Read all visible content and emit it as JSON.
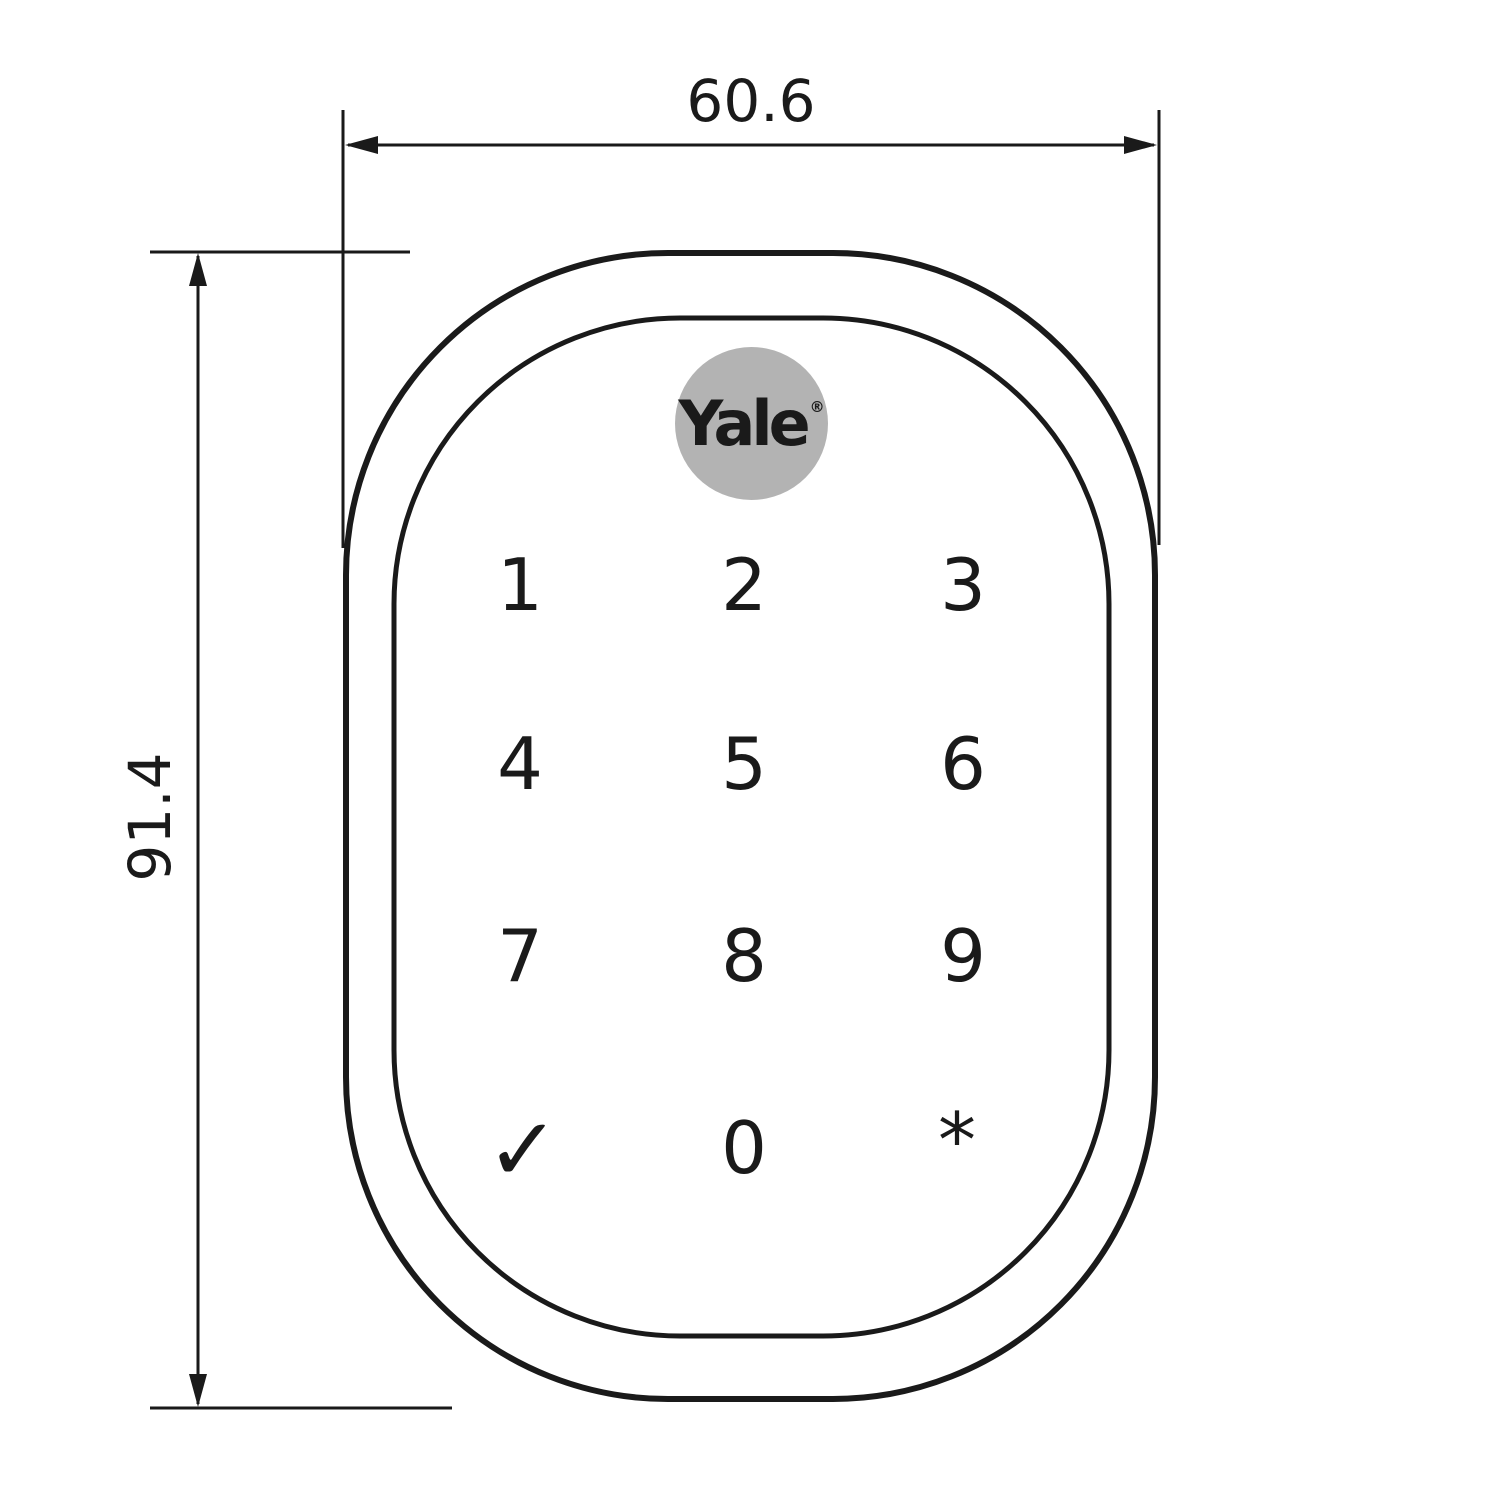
{
  "dimensions": {
    "width_label": "60.6",
    "height_label": "91.4"
  },
  "logo": {
    "text": "Yale",
    "registered_mark": "®",
    "circle_color": "#b3b3b3"
  },
  "keypad": {
    "keys": [
      "1",
      "2",
      "3",
      "4",
      "5",
      "6",
      "7",
      "8",
      "9",
      "✓",
      "0",
      "*"
    ]
  },
  "colors": {
    "line": "#1a1a1a",
    "background": "#ffffff"
  }
}
